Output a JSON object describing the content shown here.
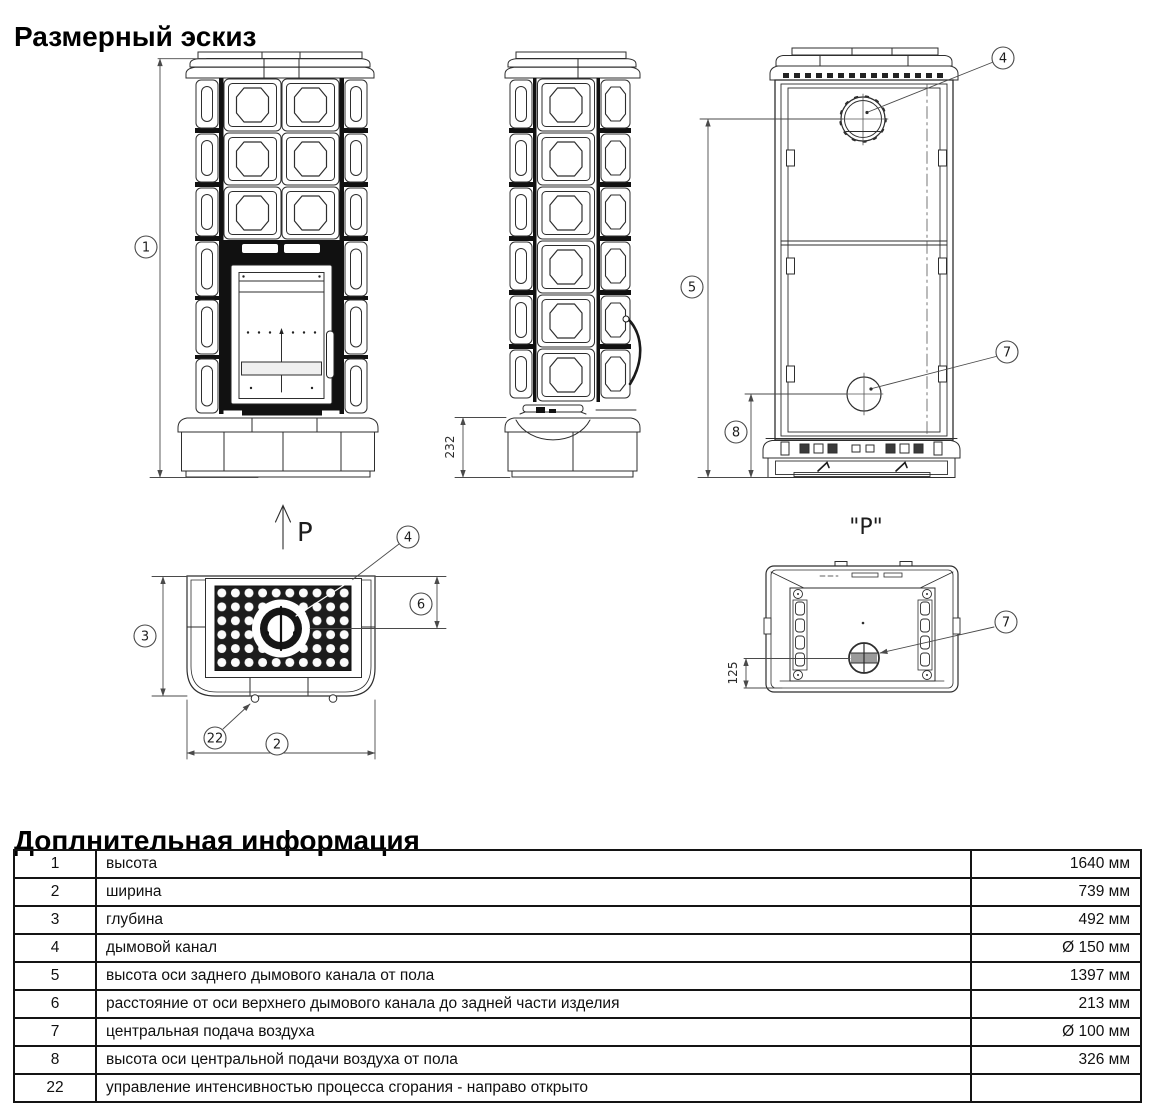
{
  "page": {
    "title": "Размерный эскиз",
    "info_title": "Доплнительная информация"
  },
  "sketch": {
    "view_direction_label": "P",
    "view_p_label": "\"P\"",
    "dim_base_height": "232",
    "dim_air_offset": "125",
    "callouts": {
      "height": "1",
      "width": "2",
      "depth": "3",
      "flue": "4",
      "flue_axis_height": "5",
      "flue_axis_offset": "6",
      "air_supply": "7",
      "air_axis_height": "8",
      "combustion_control": "22"
    }
  },
  "info_table": {
    "rows": [
      {
        "num": "1",
        "desc": "высота",
        "value": "1640 мм"
      },
      {
        "num": "2",
        "desc": "ширина",
        "value": "739 мм"
      },
      {
        "num": "3",
        "desc": "глубина",
        "value": "492 мм"
      },
      {
        "num": "4",
        "desc": "дымовой канал",
        "value": "Ø 150 мм"
      },
      {
        "num": "5",
        "desc": "высота оси заднего дымового канала от пола",
        "value": "1397 мм"
      },
      {
        "num": "6",
        "desc": "расстояние от оси верхнего дымового канала до задней части изделия",
        "value": "213 мм"
      },
      {
        "num": "7",
        "desc": "центральная подача воздуха",
        "value": "Ø 100 мм"
      },
      {
        "num": "8",
        "desc": "высота оси центральной подачи воздуха от пола",
        "value": "326 мм"
      },
      {
        "num": "22",
        "desc": "управление интенсивностью процесса сгорания - направо открыто",
        "value": ""
      }
    ]
  }
}
